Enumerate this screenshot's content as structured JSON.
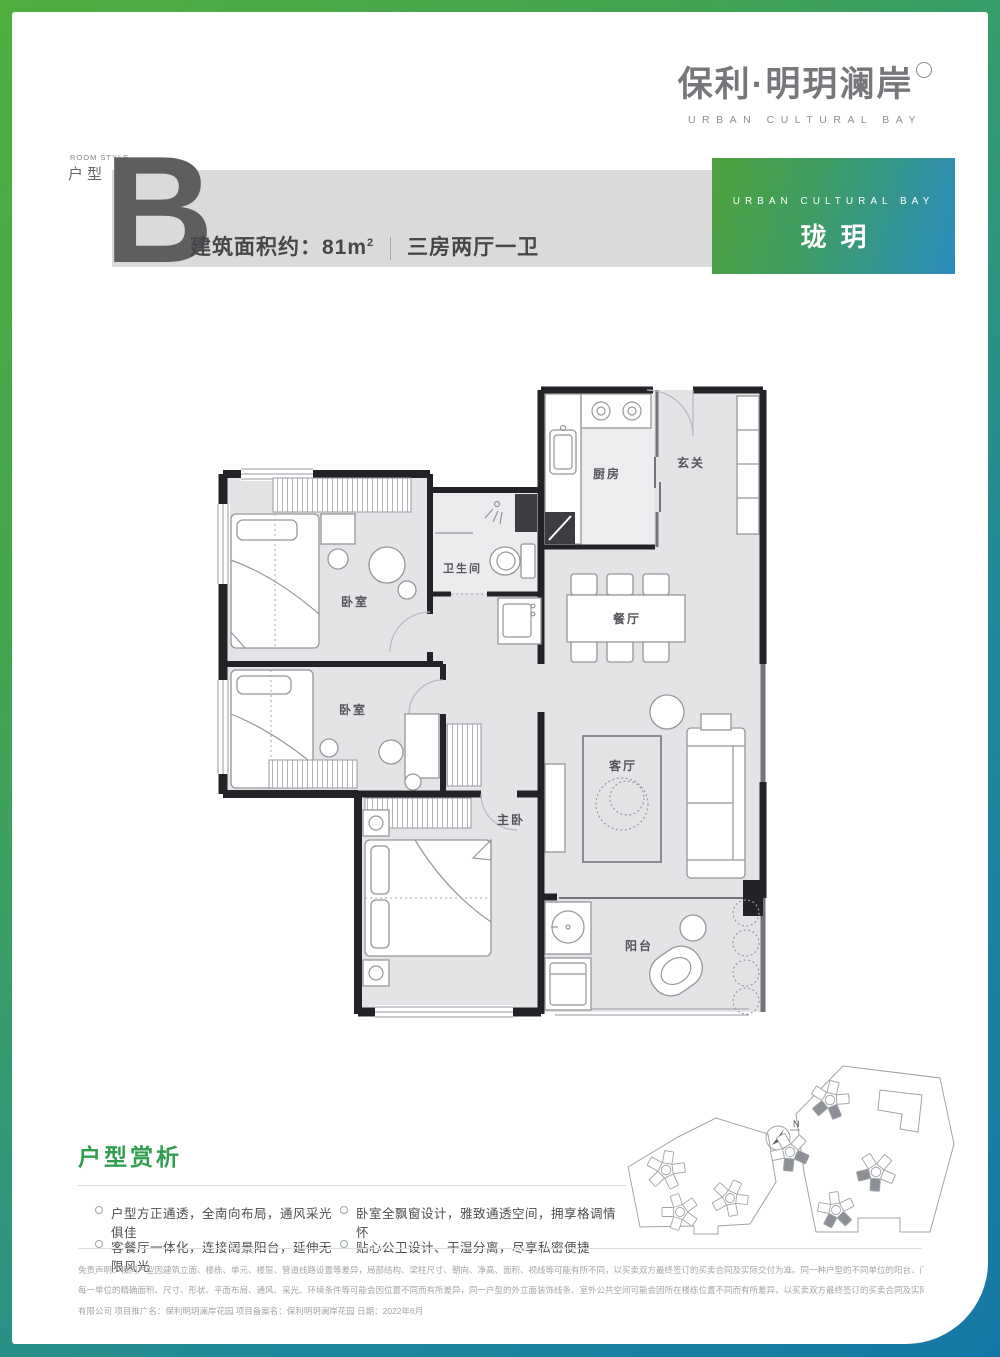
{
  "brand": {
    "logo_cn": "保利·明玥澜岸",
    "logo_en": "URBAN CULTURAL BAY"
  },
  "header": {
    "room_style_en": "ROOM STYLE",
    "room_style_cn": "户型",
    "unit_letter": "B",
    "area_label": "建筑面积约：",
    "area_value": "81m",
    "area_sup": "2",
    "layout": "三房两厅一卫"
  },
  "badge": {
    "en": "URBAN CULTURAL BAY",
    "cn": "珑玥"
  },
  "plan": {
    "kitchen": "厨房",
    "entry": "玄关",
    "bath": "卫生间",
    "dining": "餐厅",
    "bedroom1": "卧室",
    "bedroom2": "卧室",
    "master": "主卧",
    "living": "客厅",
    "balcony": "阳台"
  },
  "analysis": {
    "title": "户型赏析",
    "bullets": [
      "户型方正通透，全南向布局，通风采光俱佳",
      "卧室全飘窗设计，雅致通透空间，拥享格调情怀",
      "客餐厅一体化，连接阔景阳台，延伸无限风光",
      "贴心公卫设计、干湿分离，尽享私密便捷"
    ]
  },
  "site_plan": {
    "north": "N"
  },
  "disclaimer": {
    "lines": [
      "免责声明：相同户型因建筑立面、楼栋、单元、楼层、管道线路设置等差异，局部结构、梁柱尺寸、朝向、净高、面积、视线等可能有所不同，以买卖双方最终签订的买卖合同及实际交付为准。同一种户型的不同单位的阳台、门窗、通道、剪力墙的厚度/尺寸/位置等可能不同，",
      "每一单位的精确面积、尺寸、形状、平面布局、通风、采光、环境条件等可能会因位置不同而有所差异，同一户型的外立面装饰线条、室外公共空间可能会因所在楼栋位置不同而有所差异，以买卖双方最终签订的买卖合同及实际交付为准。开发商名称：深圳市保发房地产开发",
      "有限公司 项目推广名：保利明玥澜岸花园 项目备案名：保利明玥澜岸花园 日期：2022年6月"
    ]
  },
  "colors": {
    "frame_green": "#4fae3e",
    "frame_blue": "#1478a6",
    "accent_green": "#2f9e4f",
    "band_gray": "#dadadb",
    "unit_letter_gray": "#5d5e60"
  }
}
